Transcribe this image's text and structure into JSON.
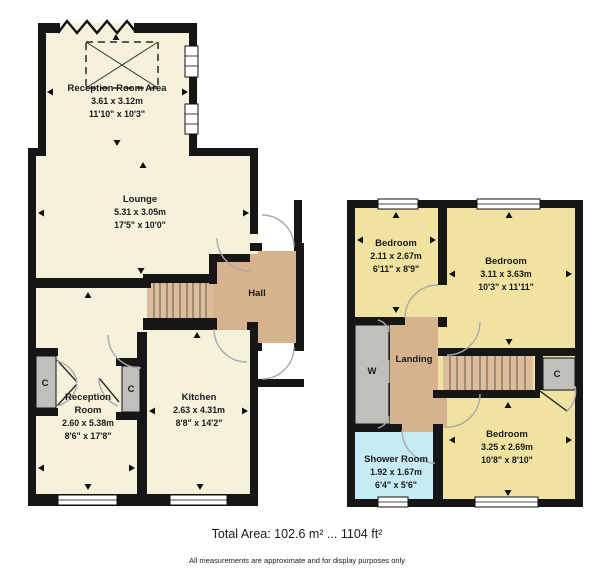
{
  "ground_floor": {
    "reception_room_area": {
      "name": "Reception Room Area",
      "metric": "3.61 x 3.12m",
      "imperial": "11'10\" x 10'3\""
    },
    "lounge": {
      "name": "Lounge",
      "metric": "5.31 x 3.05m",
      "imperial": "17'5\" x 10'0\""
    },
    "hall": {
      "name": "Hall"
    },
    "reception_room": {
      "name_line1": "Reception",
      "name_line2": "Room",
      "metric": "2.60 x 5.38m",
      "imperial": "8'6\" x 17'8\""
    },
    "kitchen": {
      "name": "Kitchen",
      "metric": "2.63 x 4.31m",
      "imperial": "8'8\" x 14'2\""
    },
    "cupboard_label": "C"
  },
  "first_floor": {
    "bedroom_front_small": {
      "name": "Bedroom",
      "metric": "2.11 x 2.67m",
      "imperial": "6'11\" x 8'9\""
    },
    "bedroom_front_large": {
      "name": "Bedroom",
      "metric": "3.11 x 3.63m",
      "imperial": "10'3\" x 11'11\""
    },
    "bedroom_rear": {
      "name": "Bedroom",
      "metric": "3.25 x 2.69m",
      "imperial": "10'8\" x 8'10\""
    },
    "landing": {
      "name": "Landing"
    },
    "shower_room": {
      "name": "Shower Room",
      "metric": "1.92 x 1.67m",
      "imperial": "6'4\" x 5'6\""
    },
    "wardrobe_label": "W",
    "cupboard_label": "C"
  },
  "footer": {
    "total_area": "Total Area: 102.6 m² ... 1104 ft²",
    "disclaimer": "All measurements are approximate and for display purposes only"
  },
  "colors": {
    "room_cream": "#F5F1DB",
    "room_yellow": "#F0E3A2",
    "hall_tan": "#D7B28E",
    "stair_tan": "#DCBD9B",
    "shower_blue": "#C6EBF5",
    "closet_grey": "#C0BFBC",
    "wall_black": "#161616"
  }
}
